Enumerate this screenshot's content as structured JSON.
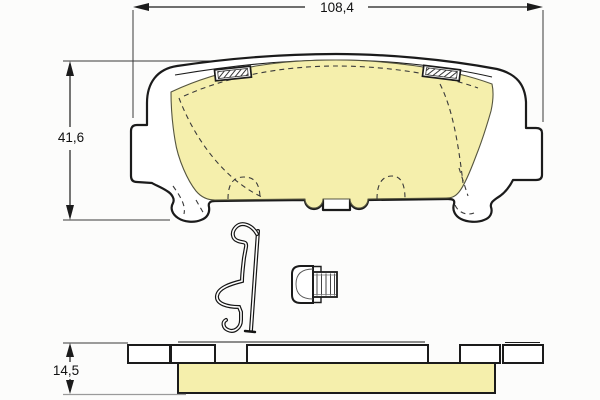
{
  "diagram": {
    "kind": "technical-drawing",
    "subject": "disc-brake-pad-set",
    "dimensions": {
      "width": {
        "label": "108,4"
      },
      "height": {
        "label": "41,6"
      },
      "thickness": {
        "label": "14,5"
      }
    },
    "colors": {
      "friction_material": "#f5efac",
      "outline": "#1b1b1b",
      "background": "#fcfcfb",
      "dashed_line": "#3a3a3a",
      "extension_line": "#4a4a4a",
      "gray_line": "#9a9a9a"
    },
    "parts": {
      "top_view": "brake-pad-front-view",
      "side_view": "brake-pad-edge-view",
      "spring": "retaining-spring-clip",
      "bushing": "wear-indicator-clip",
      "shim_tabs": "hatched-shim-tabs"
    }
  }
}
